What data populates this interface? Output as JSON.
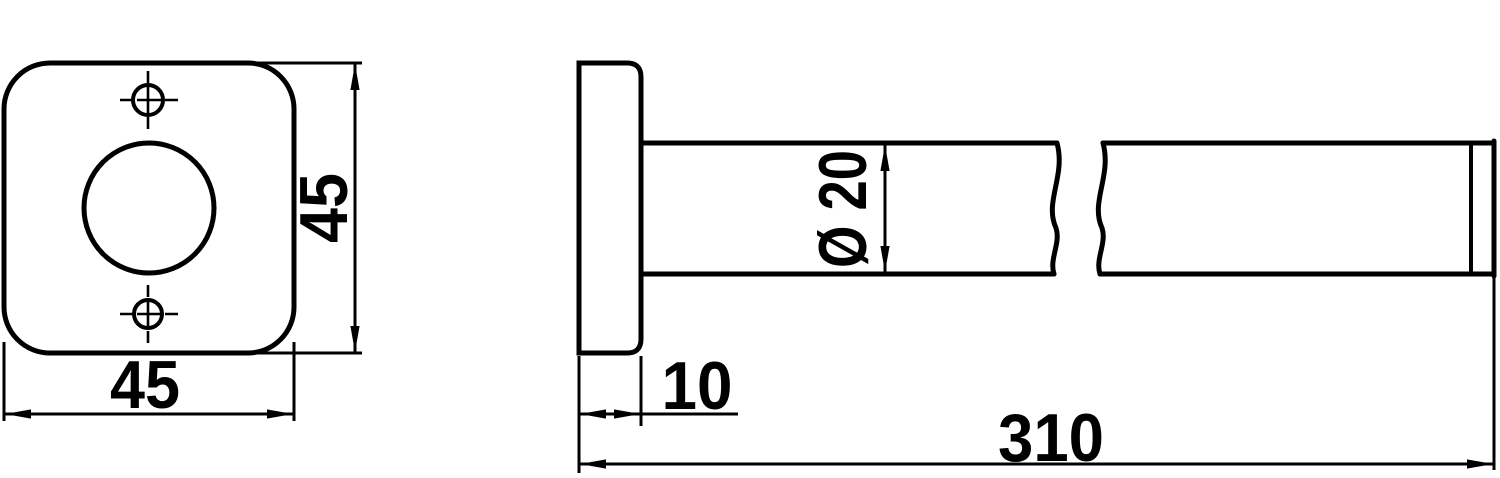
{
  "style": {
    "line_color": "#000000",
    "background_color": "#ffffff"
  },
  "front_view": {
    "width_dim": "45",
    "height_dim": "45"
  },
  "side_view": {
    "flange_thickness_dim": "10",
    "rod_diameter_dim": "Ø 20",
    "overall_length_dim": "310"
  }
}
